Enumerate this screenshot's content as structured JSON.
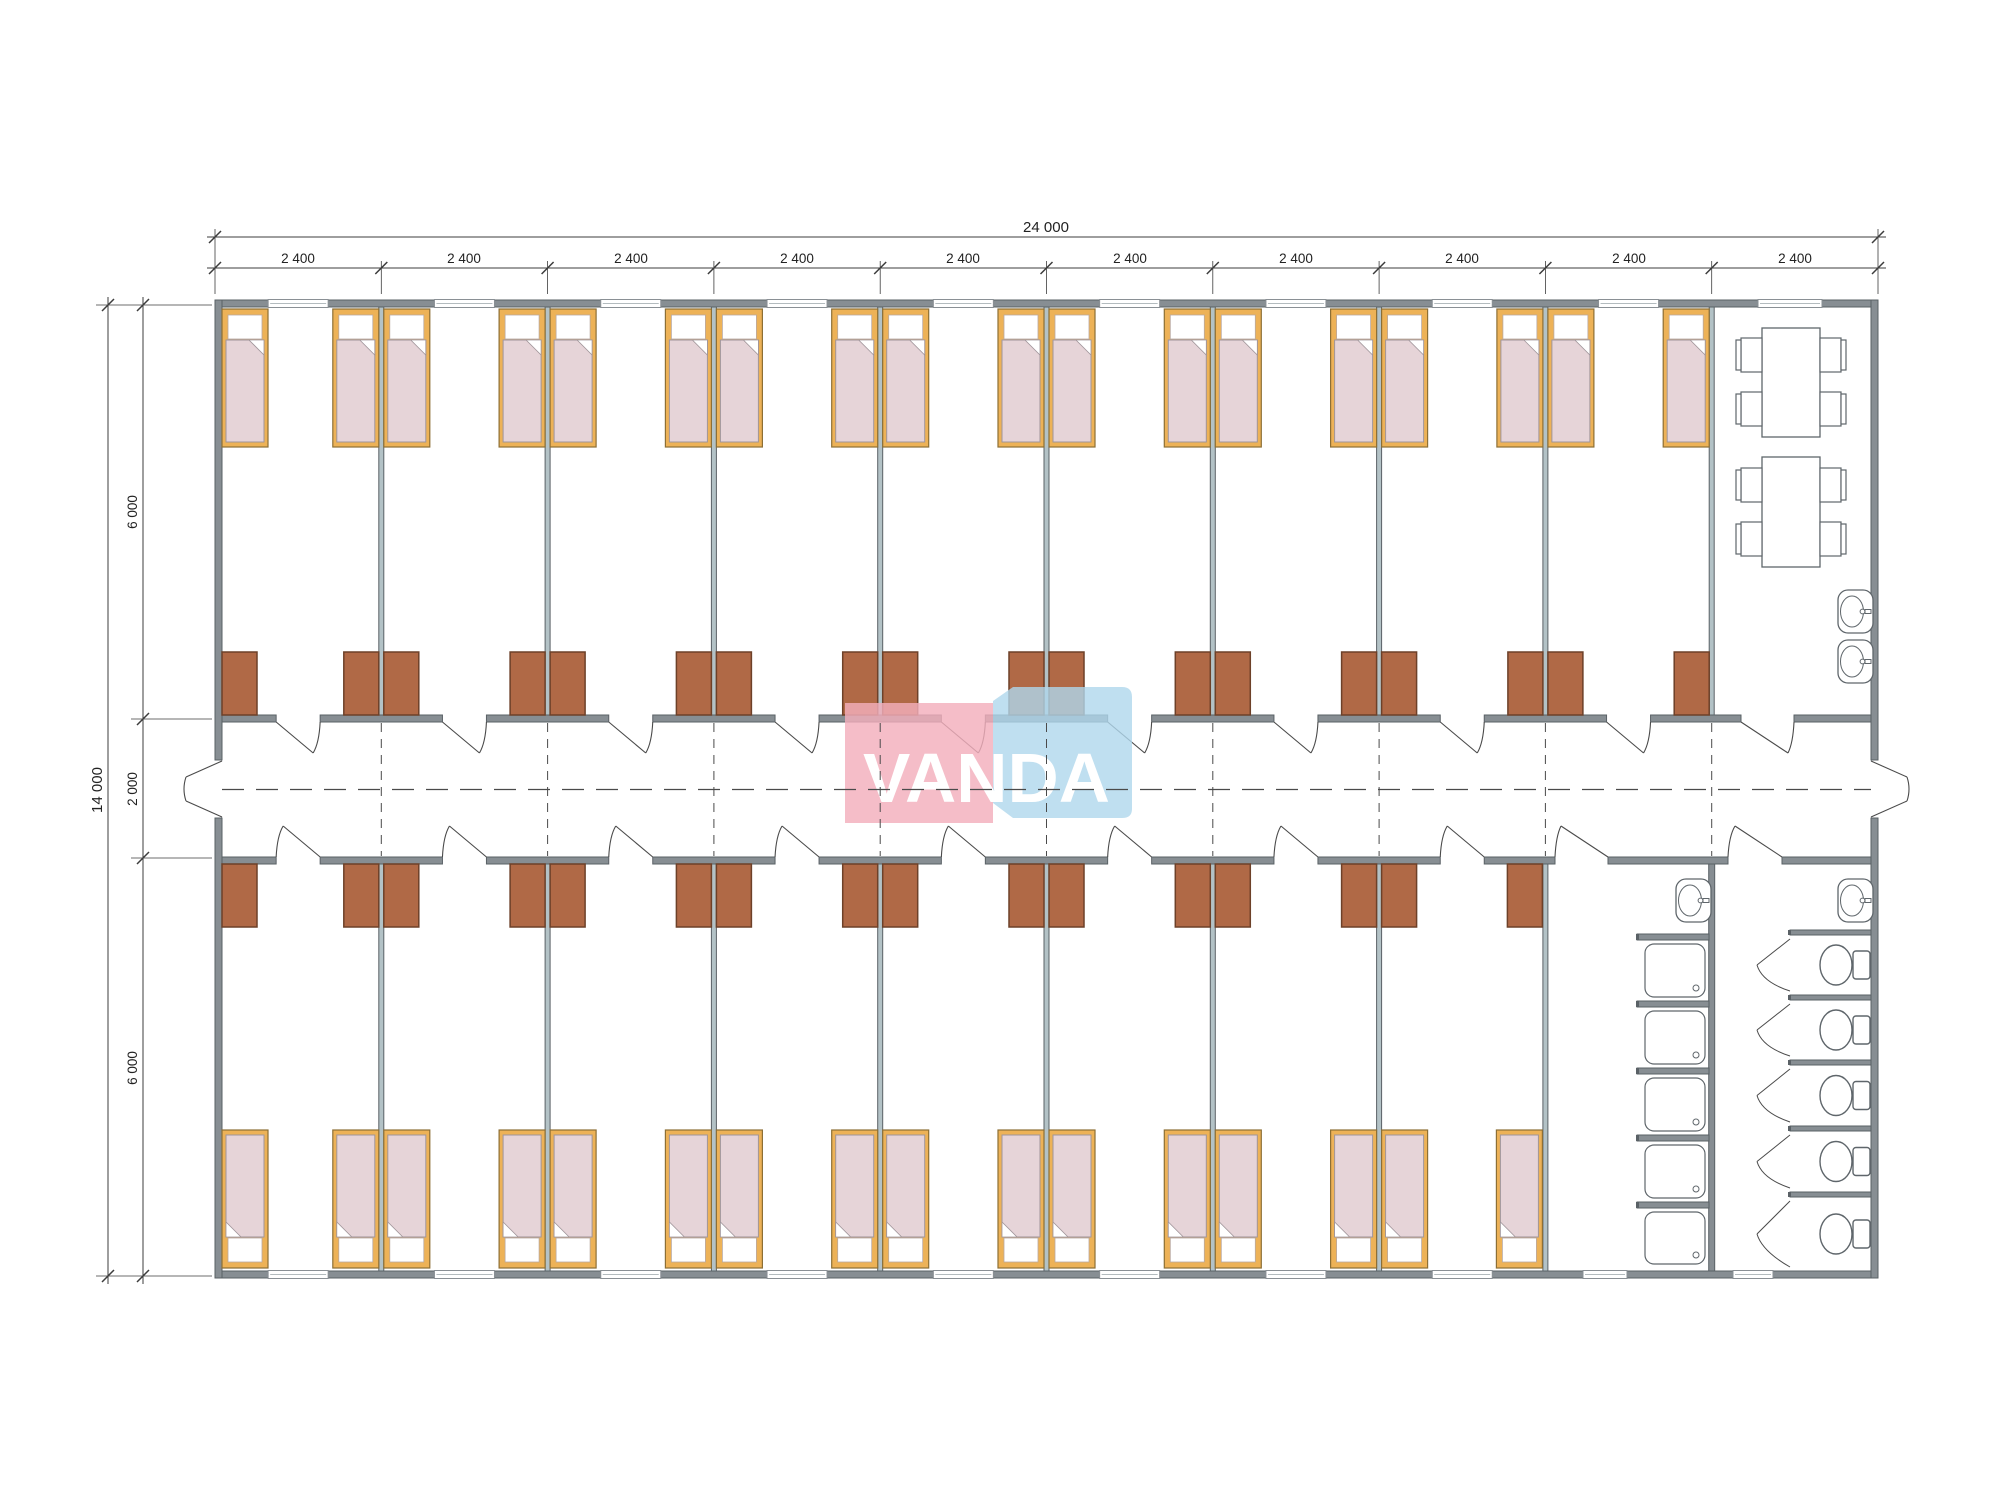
{
  "dimensions": {
    "top_total": "24 000",
    "top_segments": [
      "2 400",
      "2 400",
      "2 400",
      "2 400",
      "2 400",
      "2 400",
      "2 400",
      "2 400",
      "2 400",
      "2 400"
    ],
    "left_total": "14 000",
    "left_segments": [
      "6 000",
      "2 000",
      "6 000"
    ]
  },
  "watermark": {
    "text": "VANDA",
    "pink": "#f3afbc",
    "blue": "#afd7ec",
    "text_color": "#ffffff"
  },
  "plan": {
    "rooms_top": 9,
    "rooms_bottom": 8,
    "beds_per_room": 2,
    "wardrobes": 34,
    "dining_tables": 2,
    "chairs_per_table": 4,
    "showers": 5,
    "toilets": 5,
    "sinks": 4,
    "colors": {
      "wall": "#878e93",
      "wall_edge": "#5a6166",
      "partition": "#b3c2c6",
      "bed_frame": "#edb257",
      "bed_frame_edge": "#8d6f35",
      "bed_blanket": "#e6d4d8",
      "bed_blanket_edge": "#a0959a",
      "wardrobe": "#b06946",
      "wardrobe_edge": "#6d4129",
      "fixture_edge": "#5f666b",
      "line": "#3c3c3c",
      "door_line": "#4a4a4a",
      "background": "#ffffff"
    }
  }
}
